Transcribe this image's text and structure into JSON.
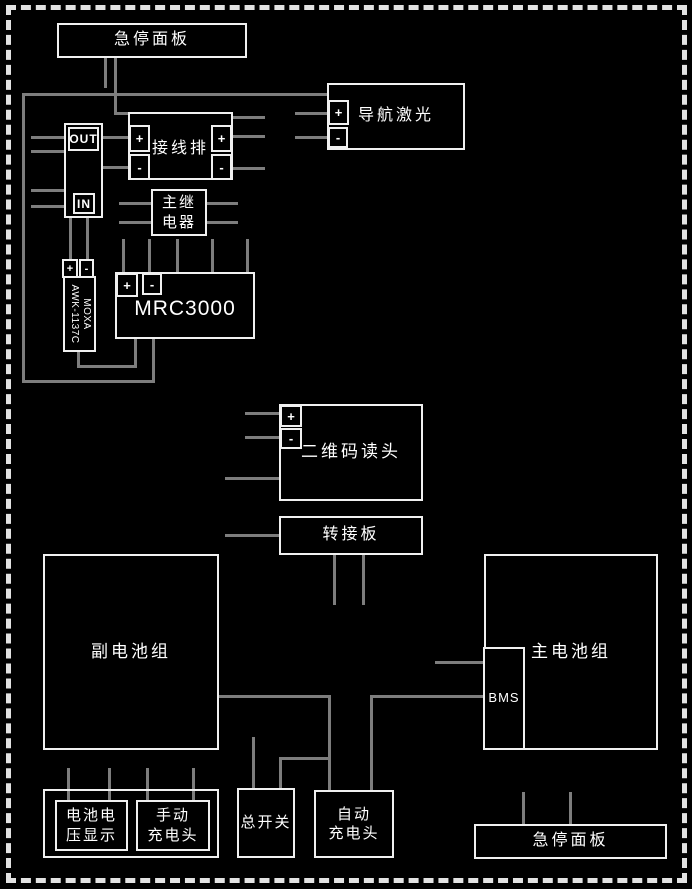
{
  "labels": {
    "emergency_panel_top": "急停面板",
    "nav_laser": "导航激光",
    "terminal_strip": "接线排",
    "main_relay": [
      "主继",
      "电器"
    ],
    "out": "OUT",
    "in": "IN",
    "moxa": [
      "MOXA",
      "AWK-1137C"
    ],
    "mrc3000": "MRC3000",
    "qr_reader": "二维码读头",
    "adapter_board": "转接板",
    "secondary_battery_pack": "副电池组",
    "main_battery_pack": "主电池组",
    "bms": "BMS",
    "battery_voltage_display": [
      "电池电",
      "压显示"
    ],
    "manual_charger": [
      "手动",
      "充电头"
    ],
    "main_switch": "总开关",
    "auto_charger": [
      "自动",
      "充电头"
    ],
    "emergency_panel_bottom": "急停面板",
    "plus": "+",
    "minus": "-"
  },
  "colors": {
    "background": "#000000",
    "wire": "#7d7d7d",
    "box_border": "#f0f0f0",
    "text": "#ffffff"
  }
}
